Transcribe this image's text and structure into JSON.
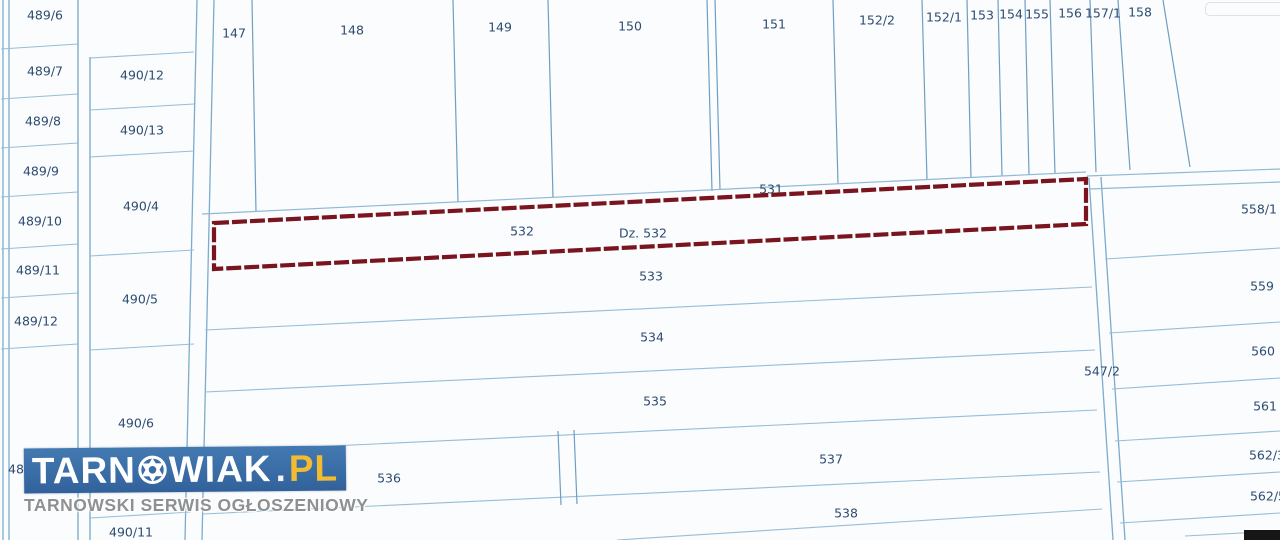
{
  "map": {
    "highlighted_parcel": {
      "id": "532",
      "annotation": "Dz. 532"
    },
    "parcel_labels": [
      {
        "id": "489/6",
        "x": 45,
        "y": 16
      },
      {
        "id": "489/7",
        "x": 45,
        "y": 72
      },
      {
        "id": "489/8",
        "x": 43,
        "y": 122
      },
      {
        "id": "489/9",
        "x": 41,
        "y": 172
      },
      {
        "id": "489/10",
        "x": 40,
        "y": 222
      },
      {
        "id": "489/11",
        "x": 38,
        "y": 271
      },
      {
        "id": "489/12",
        "x": 36,
        "y": 322
      },
      {
        "id": "489/13",
        "x": 30,
        "y": 470
      },
      {
        "id": "490/12",
        "x": 142,
        "y": 76
      },
      {
        "id": "490/13",
        "x": 142,
        "y": 131
      },
      {
        "id": "490/4",
        "x": 141,
        "y": 207
      },
      {
        "id": "490/5",
        "x": 140,
        "y": 300
      },
      {
        "id": "490/6",
        "x": 136,
        "y": 424
      },
      {
        "id": "490/11",
        "x": 131,
        "y": 533
      },
      {
        "id": "147",
        "x": 234,
        "y": 34
      },
      {
        "id": "148",
        "x": 352,
        "y": 31
      },
      {
        "id": "149",
        "x": 500,
        "y": 28
      },
      {
        "id": "150",
        "x": 630,
        "y": 27
      },
      {
        "id": "151",
        "x": 774,
        "y": 25
      },
      {
        "id": "152/2",
        "x": 877,
        "y": 21
      },
      {
        "id": "152/1",
        "x": 944,
        "y": 18
      },
      {
        "id": "153",
        "x": 982,
        "y": 16
      },
      {
        "id": "154",
        "x": 1011,
        "y": 15
      },
      {
        "id": "155",
        "x": 1037,
        "y": 15
      },
      {
        "id": "156",
        "x": 1070,
        "y": 14
      },
      {
        "id": "157/1",
        "x": 1103,
        "y": 14
      },
      {
        "id": "158",
        "x": 1140,
        "y": 13
      },
      {
        "id": "531",
        "x": 771,
        "y": 190
      },
      {
        "id": "532",
        "x": 522,
        "y": 232
      },
      {
        "id": "Dz. 532",
        "x": 643,
        "y": 234
      },
      {
        "id": "533",
        "x": 651,
        "y": 277
      },
      {
        "id": "534",
        "x": 652,
        "y": 338
      },
      {
        "id": "535",
        "x": 655,
        "y": 402
      },
      {
        "id": "536",
        "x": 389,
        "y": 479
      },
      {
        "id": "537",
        "x": 831,
        "y": 460
      },
      {
        "id": "538",
        "x": 846,
        "y": 514
      },
      {
        "id": "547/2",
        "x": 1102,
        "y": 372
      },
      {
        "id": "558/1",
        "x": 1259,
        "y": 210
      },
      {
        "id": "559",
        "x": 1262,
        "y": 287
      },
      {
        "id": "560",
        "x": 1263,
        "y": 352
      },
      {
        "id": "561",
        "x": 1265,
        "y": 407
      },
      {
        "id": "562/3",
        "x": 1267,
        "y": 456
      },
      {
        "id": "562/5",
        "x": 1268,
        "y": 497
      }
    ],
    "colors": {
      "background": "#fbfcfd",
      "boundary_line": "#97bdd8",
      "vertical_line": "#6e9ec3",
      "road_line": "#7cabcd",
      "label_text": "#2e4c72",
      "highlight_border": "#7a141f"
    }
  },
  "watermark": {
    "brand_part1": "TARN",
    "brand_part2": "WIAK",
    "dot": ".",
    "tld": "PL",
    "tagline": "TARNOWSKI SERWIS OGŁOSZENIOWY",
    "colors": {
      "banner": "#3a6da6",
      "brand_text": "#ffffff",
      "tld_text": "#f2bb30",
      "tagline_text": "#8e9091"
    }
  }
}
